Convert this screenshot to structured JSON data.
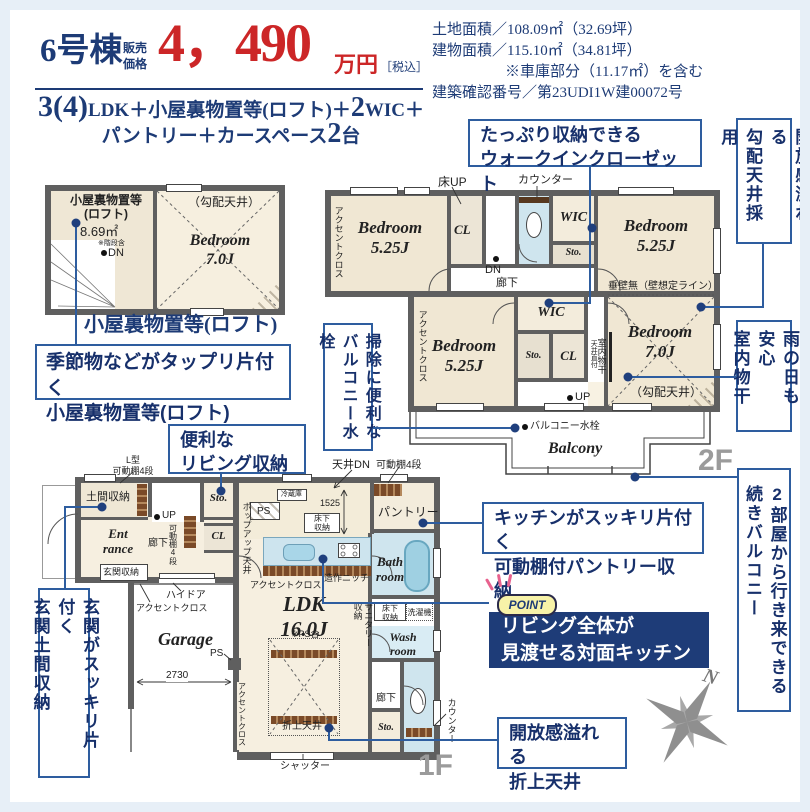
{
  "header": {
    "building_no": "6号棟",
    "price_label": "販売\n価格",
    "price_value": "4，490",
    "price_unit": "万円",
    "price_tax": "［税込］",
    "plan_big1": "3(4)",
    "plan_mid1": "LDK＋小屋裏物置等(ロフト)＋",
    "plan_big2": "2",
    "plan_mid2": "WIC＋",
    "plan_mid3": "パントリー＋カースペース",
    "plan_big3": "2",
    "plan_mid4": "台"
  },
  "site_info": {
    "line1": "土地面積／108.09㎡（32.69坪）",
    "line2": "建物面積／115.10㎡（34.81坪）",
    "line3": "※車庫部分（11.17㎡）を含む",
    "line4": "建築確認番号／第23UDI1W建00072号"
  },
  "loft": {
    "storage_name": "小屋裏物置等\n(ロフト)",
    "storage_area": "8.69㎡",
    "storage_note": "※階段含",
    "dn": "DN",
    "sloped_ceiling": "（勾配天井）",
    "bedroom": "Bedroom\n7.0J",
    "caption": "小屋裏物置等(ロフト)"
  },
  "f2": {
    "accent1": "アクセントクロス",
    "bedroom_tl": "Bedroom\n5.25J",
    "floor_up": "床UP",
    "cl1": "CL",
    "counter": "カウンター",
    "dn": "DN",
    "hall": "廊下",
    "wic1": "WIC",
    "sto1": "Sto.",
    "bedroom_tr": "Bedroom\n5.25J",
    "tarekabe": "垂壁無（壁想定ライン）",
    "accent2": "アクセントクロス",
    "bedroom_bl": "Bedroom\n5.25J",
    "wic2": "WIC",
    "sto2": "Sto.",
    "cl2": "CL",
    "tenjo_chokuzuke": "天井直付",
    "monohoshi": "室内物干",
    "bedroom_br": "Bedroom\n7.0J",
    "sloped_ceiling": "（勾配天井）",
    "up": "UP",
    "balcony_tap": "バルコニー水栓",
    "balcony": "Balcony",
    "floor_label": "2F"
  },
  "f1": {
    "l_shelf": "L型\n可動棚4段",
    "doma": "土間収納",
    "sto1": "Sto.",
    "tenjo_dn": "天井DN",
    "shelf4_top": "可動棚4段",
    "fridge": "冷蔵庫",
    "entrance": "Ent\nrance",
    "hall1": "廊下",
    "up": "UP",
    "shelf4_side": "可動棚4段",
    "cl": "CL",
    "popup_ceiling": "ポップアップ天井",
    "ps1": "PS",
    "dim1525": "1525",
    "underfloor1": "床下\n収納",
    "pantry": "パントリー",
    "genkan_sto": "玄関収納",
    "high_door": "ハイドア",
    "accent1": "アクセントクロス",
    "bath": "Bath\nroom",
    "niche": "造作ニッチ",
    "accent2": "アクセントクロス",
    "ldk": "LDK\n16.0J",
    "ps_incl": "※PS含",
    "sanitary_sto": "サニタリー\n収納",
    "underfloor2": "床下\n収納",
    "washer": "洗濯機",
    "wash": "Wash\nroom",
    "hall2": "廊下",
    "sto2": "Sto.",
    "counter": "カウンター",
    "oriage": "折上天井",
    "accent3": "アクセントクロス",
    "garage": "Garage",
    "dim2730": "2730",
    "ps2": "PS",
    "shutter": "シャッター",
    "floor_label": "1F"
  },
  "callouts": {
    "loft": "季節物などがタップリ片付く\n小屋裏物置等(ロフト)",
    "wic": "たっぷり収納できる\nウォークインクローゼット",
    "sloped": "開放感溢れる\n勾配天井採用",
    "monohoshi": "雨の日も安心\n室内物干",
    "balcony2": "2部屋から行き来できる\n続きバルコニー",
    "tap": "掃除に便利な\nバルコニー水栓",
    "living_sto": "便利な\nリビング収納",
    "genkan": "玄関がスッキリ片付く\n玄関土間収納",
    "pantry": "キッチンがスッキリ片付く\n可動棚付パントリー収納",
    "point_badge": "POINT",
    "point_text": "リビング全体が\n見渡せる対面キッチン",
    "oriage": "開放感溢れる\n折上天井",
    "compass_n": "N"
  },
  "colors": {
    "navy": "#1d3b76",
    "price_red": "#cc2627",
    "callout_border": "#2e5d9f",
    "wall_gray": "#5f5f5f",
    "room_beige": "#f0e7d3",
    "room_cream": "#f8f2e3",
    "water_blue": "#cfe5ee",
    "wood_brown": "#7a4a28",
    "floor_label_gray": "#9b9b9b",
    "point_bg": "#1e3c78",
    "badge_yellow": "#f7f2a8",
    "spark_pink": "#e8628e"
  }
}
